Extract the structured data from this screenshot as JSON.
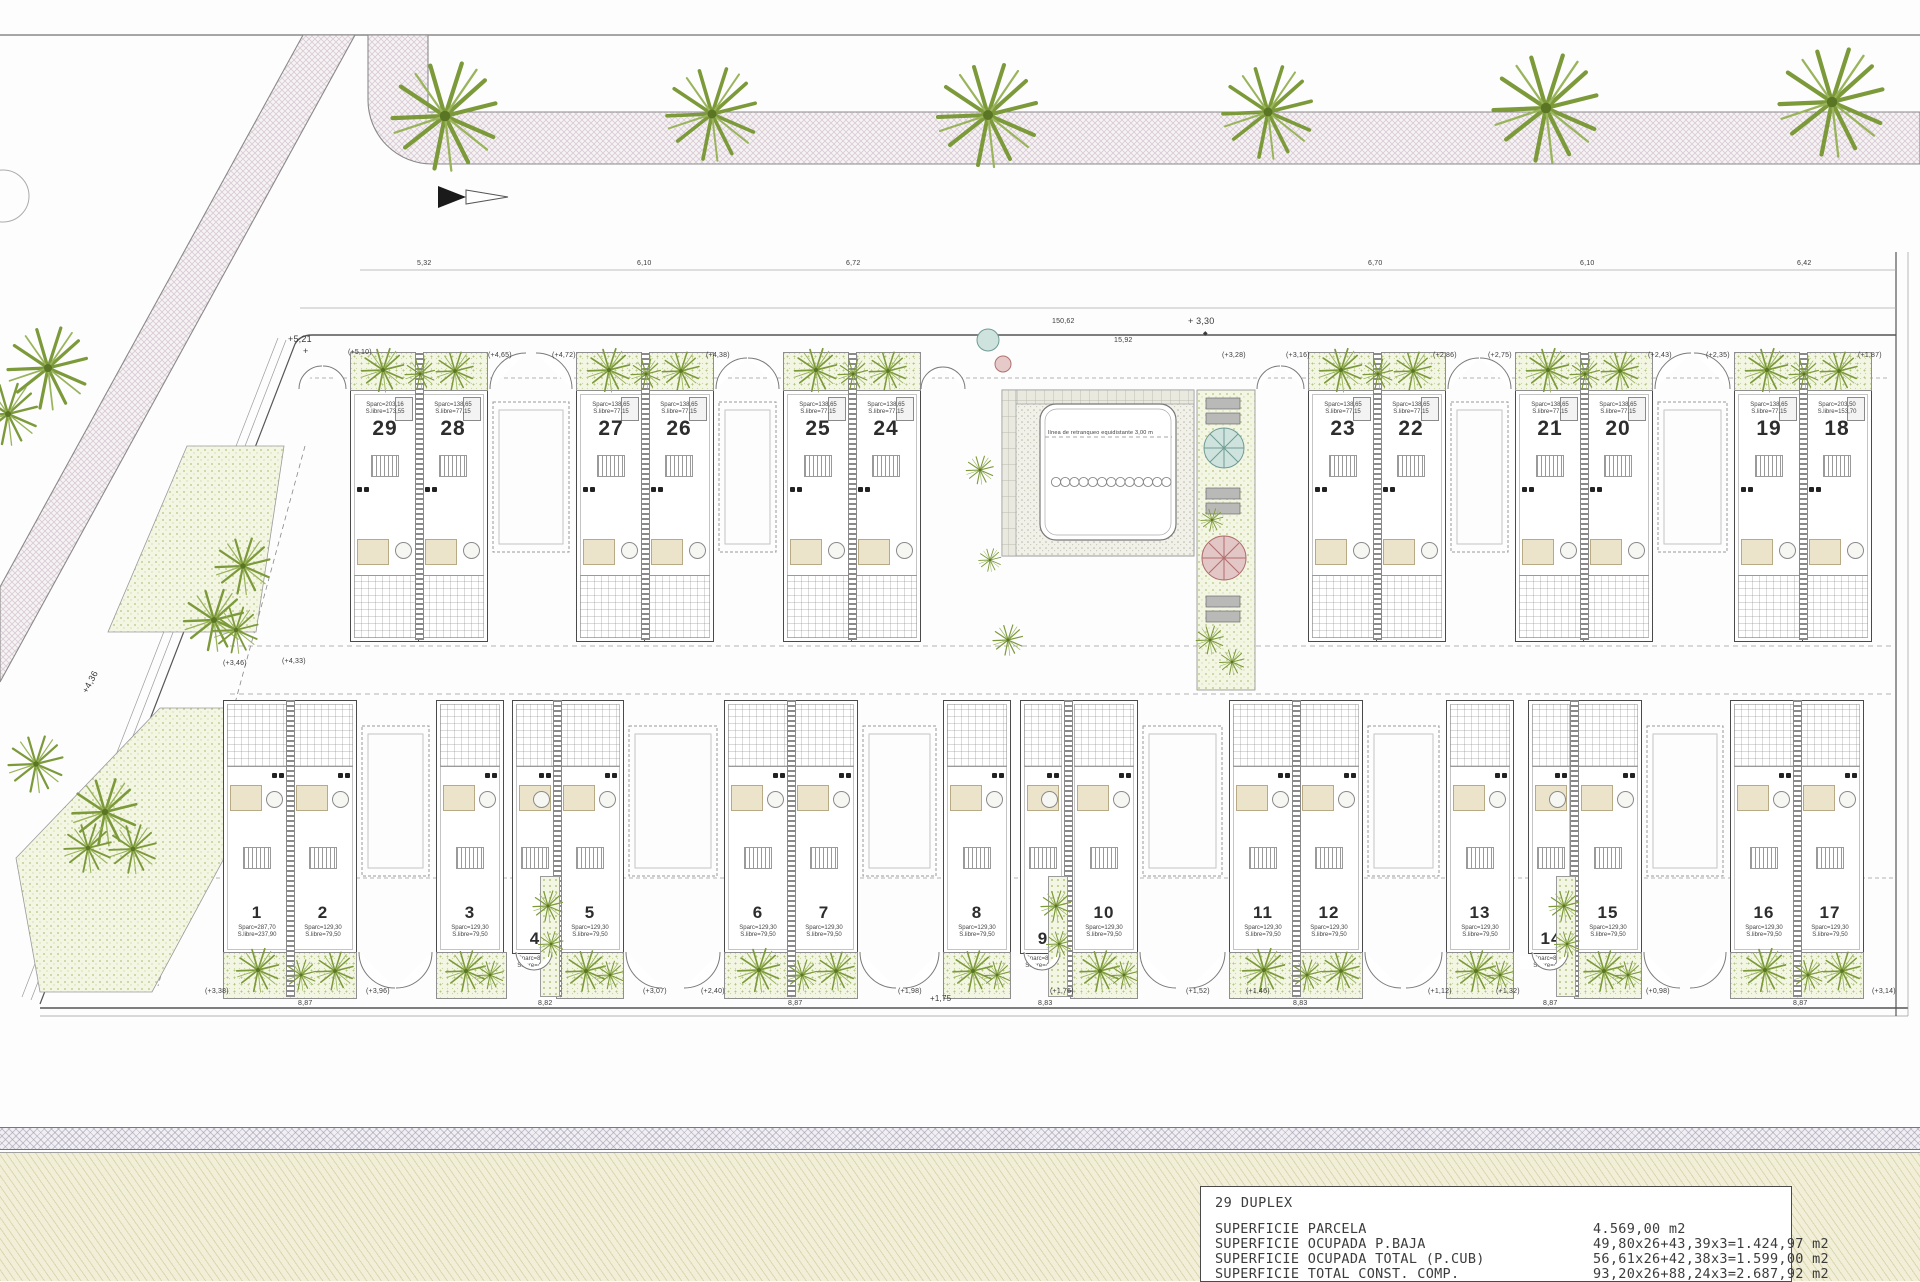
{
  "title_block": {
    "title": "29 DUPLEX",
    "rows": [
      {
        "label": "SUPERFICIE PARCELA",
        "value": "4.569,00 m2"
      },
      {
        "label": "SUPERFICIE OCUPADA P.BAJA",
        "value": "49,80x26+43,39x3=1.424,97 m2"
      },
      {
        "label": "SUPERFICIE OCUPADA TOTAL (P.CUB)",
        "value": "56,61x26+42,38x3=1.599,00 m2"
      },
      {
        "label": "SUPERFICIE TOTAL CONST. COMP.",
        "value": "93,20x26+88,24x3=2.687,92 m2"
      }
    ]
  },
  "pool": {
    "setback_text": "línea de retranqueo equidistante 3,00 m",
    "lane_circles": 13
  },
  "units_top": [
    {
      "num": "29",
      "area1": "Sparc=203,16",
      "area2": "S.libre=173,55",
      "x": 350
    },
    {
      "num": "28",
      "area1": "Sparc=138,65",
      "area2": "S.libre=77,15",
      "x": 418
    },
    {
      "num": "27",
      "area1": "Sparc=138,65",
      "area2": "S.libre=77,15",
      "x": 576
    },
    {
      "num": "26",
      "area1": "Sparc=138,65",
      "area2": "S.libre=77,15",
      "x": 644
    },
    {
      "num": "25",
      "area1": "Sparc=138,65",
      "area2": "S.libre=77,15",
      "x": 783
    },
    {
      "num": "24",
      "area1": "Sparc=138,65",
      "area2": "S.libre=77,15",
      "x": 851
    },
    {
      "num": "23",
      "area1": "Sparc=138,65",
      "area2": "S.libre=77,15",
      "x": 1308
    },
    {
      "num": "22",
      "area1": "Sparc=138,65",
      "area2": "S.libre=77,15",
      "x": 1376
    },
    {
      "num": "21",
      "area1": "Sparc=138,65",
      "area2": "S.libre=77,15",
      "x": 1515
    },
    {
      "num": "20",
      "area1": "Sparc=138,65",
      "area2": "S.libre=77,15",
      "x": 1583
    },
    {
      "num": "19",
      "area1": "Sparc=138,65",
      "area2": "S.libre=77,15",
      "x": 1734
    },
    {
      "num": "18",
      "area1": "Sparc=203,50",
      "area2": "S.libre=153,70",
      "x": 1802
    }
  ],
  "units_bottom": [
    {
      "num": "1",
      "area1": "Sparc=287,70",
      "area2": "S.libre=237,90",
      "x": 223,
      "w": 66
    },
    {
      "num": "2",
      "area1": "Sparc=129,30",
      "area2": "S.libre=79,50",
      "x": 289,
      "w": 66
    },
    {
      "num": "3",
      "area1": "Sparc=129,30",
      "area2": "S.libre=79,50",
      "x": 436,
      "w": 66
    },
    {
      "num": "4",
      "area1": "Sparc=88,03",
      "area2": "S.libre=42,84",
      "x": 512,
      "w": 44,
      "narrow": true
    },
    {
      "num": "5",
      "area1": "Sparc=129,30",
      "area2": "S.libre=79,50",
      "x": 556,
      "w": 66
    },
    {
      "num": "6",
      "area1": "Sparc=129,30",
      "area2": "S.libre=79,50",
      "x": 724,
      "w": 66
    },
    {
      "num": "7",
      "area1": "Sparc=129,30",
      "area2": "S.libre=79,50",
      "x": 790,
      "w": 66
    },
    {
      "num": "8",
      "area1": "Sparc=129,30",
      "area2": "S.libre=79,50",
      "x": 943,
      "w": 66
    },
    {
      "num": "9",
      "area1": "Sparc=88,03",
      "area2": "S.libre=42,84",
      "x": 1020,
      "w": 44,
      "narrow": true
    },
    {
      "num": "10",
      "area1": "Sparc=129,30",
      "area2": "S.libre=79,50",
      "x": 1070,
      "w": 66
    },
    {
      "num": "11",
      "area1": "Sparc=129,30",
      "area2": "S.libre=79,50",
      "x": 1229,
      "w": 66
    },
    {
      "num": "12",
      "area1": "Sparc=129,30",
      "area2": "S.libre=79,50",
      "x": 1295,
      "w": 66
    },
    {
      "num": "13",
      "area1": "Sparc=129,30",
      "area2": "S.libre=79,50",
      "x": 1446,
      "w": 66
    },
    {
      "num": "14",
      "area1": "Sparc=88,03",
      "area2": "S.libre=42,84",
      "x": 1528,
      "w": 44,
      "narrow": true
    },
    {
      "num": "15",
      "area1": "Sparc=129,30",
      "area2": "S.libre=79,50",
      "x": 1574,
      "w": 66
    },
    {
      "num": "16",
      "area1": "Sparc=129,30",
      "area2": "S.libre=79,50",
      "x": 1730,
      "w": 66
    },
    {
      "num": "17",
      "area1": "Sparc=129,30",
      "area2": "S.libre=79,50",
      "x": 1796,
      "w": 66
    }
  ],
  "annotations": [
    {
      "x": 288,
      "y": 334,
      "t": "+5,21",
      "s": 9
    },
    {
      "x": 303,
      "y": 346,
      "t": "+",
      "s": 9
    },
    {
      "x": 348,
      "y": 349,
      "t": "(+5,10)"
    },
    {
      "x": 1188,
      "y": 316,
      "t": "+ 3,30",
      "s": 9
    },
    {
      "x": 1203,
      "y": 330,
      "t": "◆",
      "s": 6
    },
    {
      "x": 1052,
      "y": 318,
      "t": "150,62"
    },
    {
      "x": 1114,
      "y": 337,
      "t": "15,92"
    },
    {
      "x": 80,
      "y": 690,
      "t": "+4,36",
      "r": -62,
      "s": 9
    },
    {
      "x": 930,
      "y": 994,
      "t": "+1,75",
      "s": 8
    },
    {
      "x": 417,
      "y": 260,
      "t": "5,32"
    },
    {
      "x": 637,
      "y": 260,
      "t": "6,10"
    },
    {
      "x": 846,
      "y": 260,
      "t": "6,72"
    },
    {
      "x": 1368,
      "y": 260,
      "t": "6,70"
    },
    {
      "x": 1580,
      "y": 260,
      "t": "6,10"
    },
    {
      "x": 1797,
      "y": 260,
      "t": "6,42"
    },
    {
      "x": 488,
      "y": 352,
      "t": "(+4,65)"
    },
    {
      "x": 552,
      "y": 352,
      "t": "(+4,72)"
    },
    {
      "x": 706,
      "y": 352,
      "t": "(+4,38)"
    },
    {
      "x": 1222,
      "y": 352,
      "t": "(+3,28)"
    },
    {
      "x": 1286,
      "y": 352,
      "t": "(+3,16)"
    },
    {
      "x": 1433,
      "y": 352,
      "t": "(+2,86)"
    },
    {
      "x": 1488,
      "y": 352,
      "t": "(+2,75)"
    },
    {
      "x": 1648,
      "y": 352,
      "t": "(+2,43)"
    },
    {
      "x": 1706,
      "y": 352,
      "t": "(+2,35)"
    },
    {
      "x": 1858,
      "y": 352,
      "t": "(+1,87)"
    },
    {
      "x": 223,
      "y": 660,
      "t": "(+3,46)"
    },
    {
      "x": 282,
      "y": 658,
      "t": "(+4,33)"
    },
    {
      "x": 205,
      "y": 988,
      "t": "(+3,38)"
    },
    {
      "x": 366,
      "y": 988,
      "t": "(+3,96)"
    },
    {
      "x": 643,
      "y": 988,
      "t": "(+3,07)"
    },
    {
      "x": 701,
      "y": 988,
      "t": "(+2,40)"
    },
    {
      "x": 898,
      "y": 988,
      "t": "(+1,98)"
    },
    {
      "x": 1050,
      "y": 988,
      "t": "(+1,76)"
    },
    {
      "x": 1186,
      "y": 988,
      "t": "(+1,52)"
    },
    {
      "x": 1246,
      "y": 988,
      "t": "(+1,46)"
    },
    {
      "x": 1428,
      "y": 988,
      "t": "(+1,12)"
    },
    {
      "x": 1496,
      "y": 988,
      "t": "(+1,32)"
    },
    {
      "x": 1646,
      "y": 988,
      "t": "(+0,98)"
    },
    {
      "x": 1872,
      "y": 988,
      "t": "(+3,14)"
    },
    {
      "x": 298,
      "y": 1000,
      "t": "8,87"
    },
    {
      "x": 538,
      "y": 1000,
      "t": "8,82"
    },
    {
      "x": 788,
      "y": 1000,
      "t": "8,87"
    },
    {
      "x": 1038,
      "y": 1000,
      "t": "8,83"
    },
    {
      "x": 1293,
      "y": 1000,
      "t": "8,83"
    },
    {
      "x": 1543,
      "y": 1000,
      "t": "8,87"
    },
    {
      "x": 1793,
      "y": 1000,
      "t": "8,87"
    }
  ],
  "layout": {
    "gardens_top": [
      [
        350,
        486
      ],
      [
        576,
        712
      ],
      [
        783,
        919
      ],
      [
        1308,
        1444
      ],
      [
        1515,
        1651
      ],
      [
        1734,
        1870
      ]
    ],
    "gardens_bottom": [
      [
        223,
        355
      ],
      [
        436,
        505
      ],
      [
        556,
        622
      ],
      [
        724,
        856
      ],
      [
        943,
        1009
      ],
      [
        1070,
        1136
      ],
      [
        1229,
        1361
      ],
      [
        1446,
        1512
      ],
      [
        1574,
        1640
      ],
      [
        1730,
        1862
      ]
    ],
    "walls_top": [
      418,
      644,
      851,
      1376,
      1583,
      1802
    ],
    "walls_bottom": [
      289,
      556,
      790,
      1067,
      1295,
      1573,
      1796
    ],
    "side_strips": [
      [
        540,
        876
      ],
      [
        1048,
        876
      ],
      [
        1556,
        876
      ]
    ],
    "carports_top": [
      [
        490,
        572
      ],
      [
        716,
        779
      ],
      [
        1448,
        1511
      ],
      [
        1655,
        1730
      ]
    ],
    "carports_bottom": [
      [
        359,
        432
      ],
      [
        626,
        720
      ],
      [
        860,
        939
      ],
      [
        1140,
        1225
      ],
      [
        1365,
        1442
      ],
      [
        1644,
        1726
      ]
    ],
    "arcs_top": [
      [
        299,
        346
      ],
      [
        490,
        572
      ],
      [
        716,
        779
      ],
      [
        921,
        965
      ],
      [
        1257,
        1304
      ],
      [
        1448,
        1511
      ],
      [
        1655,
        1730
      ]
    ],
    "arcs_bottom_extra": [
      [
        516,
        552
      ],
      [
        1024,
        1060
      ],
      [
        1532,
        1568
      ]
    ],
    "palms": [
      [
        445,
        116,
        2.1
      ],
      [
        712,
        114,
        1.8
      ],
      [
        988,
        115,
        2.0
      ],
      [
        1268,
        112,
        1.8
      ],
      [
        1546,
        108,
        2.1
      ],
      [
        1832,
        102,
        2.1
      ],
      [
        48,
        368,
        1.6
      ],
      [
        8,
        414,
        1.2
      ],
      [
        243,
        566,
        1.1
      ],
      [
        214,
        620,
        1.2
      ],
      [
        236,
        630,
        0.9
      ],
      [
        36,
        764,
        1.1
      ],
      [
        105,
        812,
        1.3
      ],
      [
        88,
        848,
        0.95
      ],
      [
        133,
        849,
        0.95
      ],
      [
        383,
        370,
        0.85
      ],
      [
        420,
        374,
        0.6
      ],
      [
        455,
        371,
        0.75
      ],
      [
        609,
        370,
        0.85
      ],
      [
        646,
        374,
        0.6
      ],
      [
        681,
        371,
        0.75
      ],
      [
        816,
        370,
        0.85
      ],
      [
        853,
        374,
        0.6
      ],
      [
        888,
        371,
        0.75
      ],
      [
        1341,
        370,
        0.85
      ],
      [
        1378,
        374,
        0.6
      ],
      [
        1413,
        371,
        0.75
      ],
      [
        1548,
        370,
        0.85
      ],
      [
        1585,
        374,
        0.6
      ],
      [
        1620,
        371,
        0.75
      ],
      [
        1767,
        370,
        0.85
      ],
      [
        1804,
        374,
        0.6
      ],
      [
        1839,
        371,
        0.75
      ],
      [
        258,
        970,
        0.85
      ],
      [
        301,
        975,
        0.6
      ],
      [
        335,
        971,
        0.75
      ],
      [
        759,
        970,
        0.85
      ],
      [
        802,
        975,
        0.6
      ],
      [
        836,
        971,
        0.75
      ],
      [
        1264,
        970,
        0.85
      ],
      [
        1307,
        975,
        0.6
      ],
      [
        1341,
        971,
        0.75
      ],
      [
        1765,
        970,
        0.85
      ],
      [
        1808,
        975,
        0.6
      ],
      [
        1842,
        971,
        0.75
      ],
      [
        466,
        971,
        0.8
      ],
      [
        490,
        975,
        0.55
      ],
      [
        586,
        971,
        0.8
      ],
      [
        610,
        975,
        0.55
      ],
      [
        973,
        971,
        0.8
      ],
      [
        997,
        975,
        0.55
      ],
      [
        1100,
        971,
        0.8
      ],
      [
        1124,
        975,
        0.55
      ],
      [
        1476,
        971,
        0.8
      ],
      [
        1500,
        975,
        0.55
      ],
      [
        1604,
        971,
        0.8
      ],
      [
        1628,
        975,
        0.55
      ],
      [
        548,
        906,
        0.6
      ],
      [
        551,
        944,
        0.5
      ],
      [
        1056,
        906,
        0.6
      ],
      [
        1059,
        944,
        0.5
      ],
      [
        1564,
        906,
        0.6
      ],
      [
        1567,
        944,
        0.5
      ],
      [
        980,
        470,
        0.55
      ],
      [
        1008,
        640,
        0.6
      ],
      [
        990,
        560,
        0.45
      ],
      [
        1210,
        640,
        0.55
      ],
      [
        1232,
        662,
        0.5
      ],
      [
        1212,
        520,
        0.45
      ]
    ]
  }
}
